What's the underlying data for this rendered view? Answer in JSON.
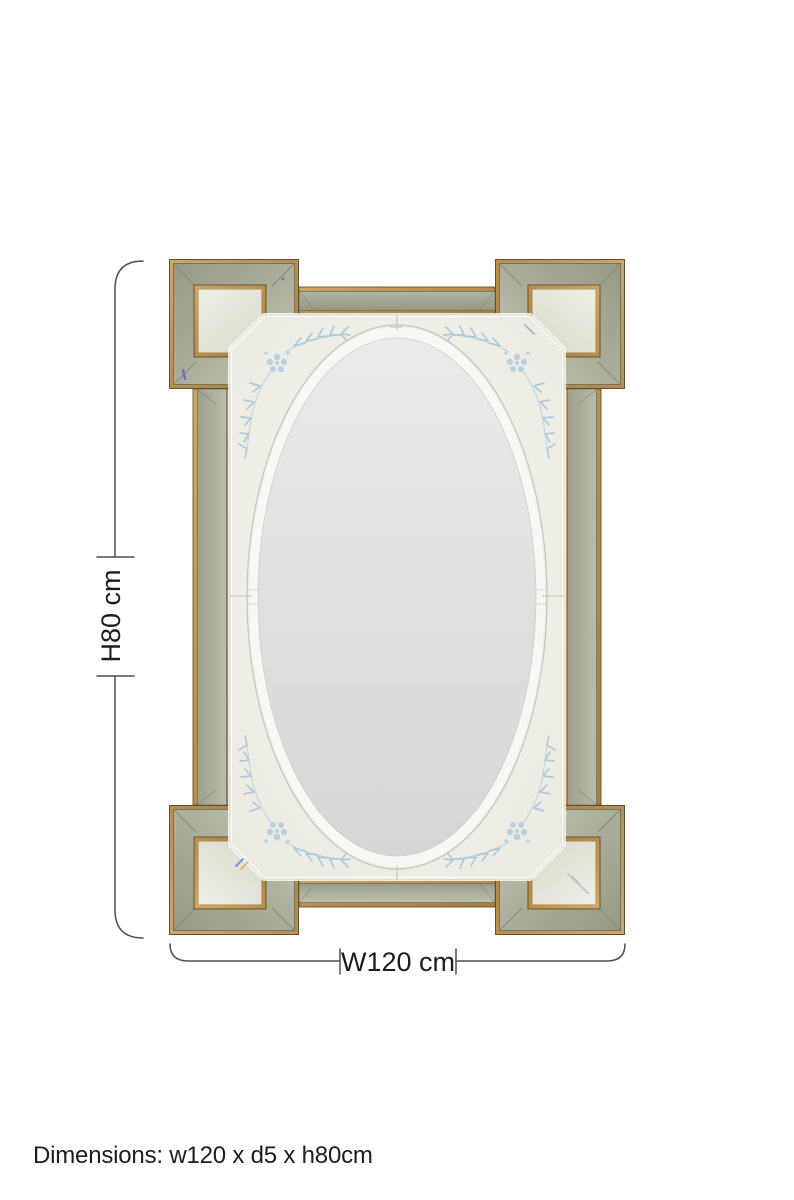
{
  "product": {
    "type": "rectangular wall mirror with mirrored corner-block frame, gold trim, etched floral corners and central oval bevelled mirror",
    "width_cm": 120,
    "depth_cm": 5,
    "height_cm": 80
  },
  "annotations": {
    "height_label": "H80 cm",
    "width_label": "W120 cm",
    "caption": "Dimensions: w120 x d5 x h80cm"
  },
  "colors": {
    "background": "#ffffff",
    "gold": "#b8914f",
    "goldline": "#65552c",
    "strip": "#a9ac99",
    "stripline": "#6e7260",
    "panel": "#e6e5da",
    "field": "#f3f2ec",
    "oval": "#dfdfde",
    "etch": "#a9c8db",
    "etchflower": "#b4cfe0",
    "dimline": "#4f4f4f",
    "textcolor": "#1d1d1d"
  }
}
